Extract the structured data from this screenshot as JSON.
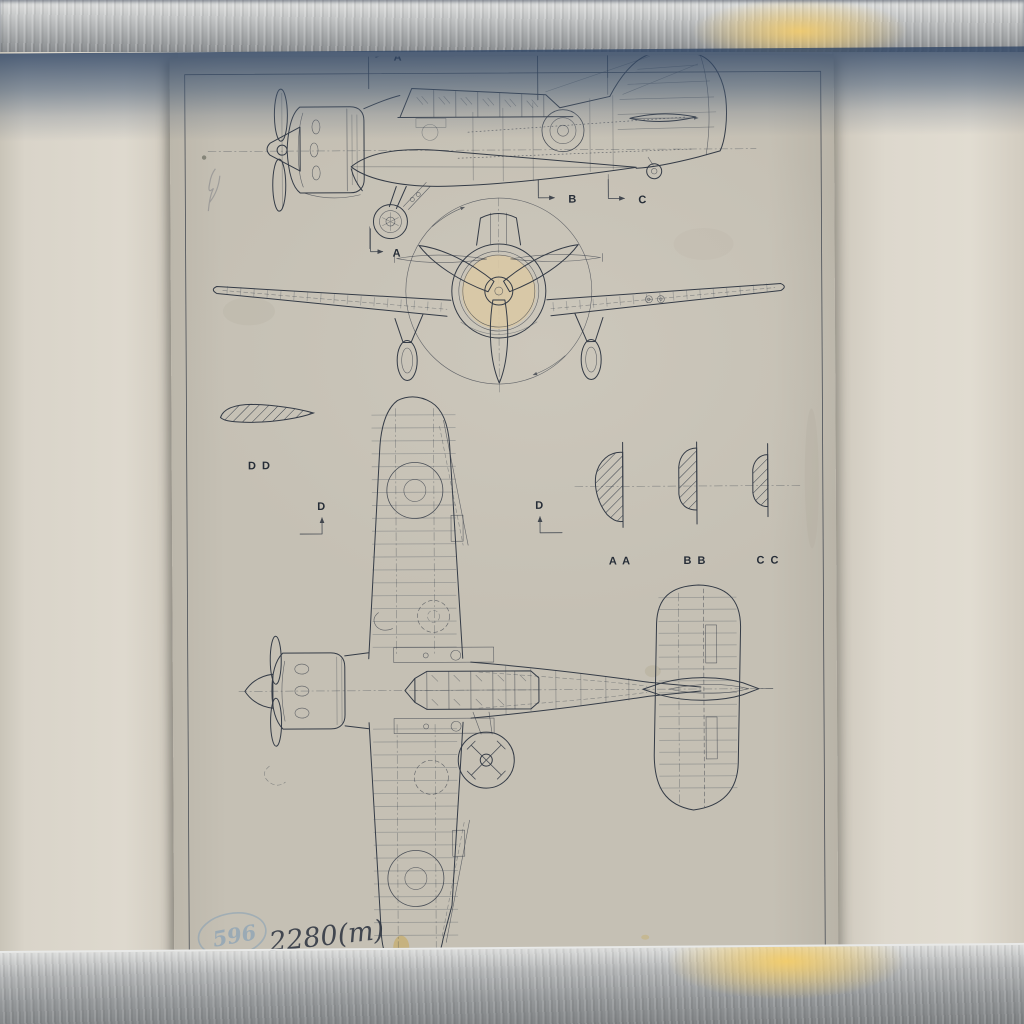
{
  "title_block": {
    "title": "MILES MARTINET I",
    "number": "M-25"
  },
  "annotations": {
    "ink_number": "2280(m)",
    "stamp_number": "596"
  },
  "scale_bar": {
    "label": "F.T."
  },
  "labels": {
    "a": "A",
    "b": "B",
    "c": "C",
    "d": "D",
    "dd": "D D",
    "aa": "A A",
    "bb": "B B",
    "cc": "C C"
  },
  "colors": {
    "paper": "#c5c0b4",
    "ink": "#343b46",
    "mat_panel": "#ddd8cd",
    "metal": "#a9abad",
    "reflection_blue": "#42586f",
    "glare": "#f3cd6c",
    "stamp_blue": "#7e9cb6",
    "engine_stain": "#d9c8a5",
    "yellow_stain": "#c7a449"
  }
}
